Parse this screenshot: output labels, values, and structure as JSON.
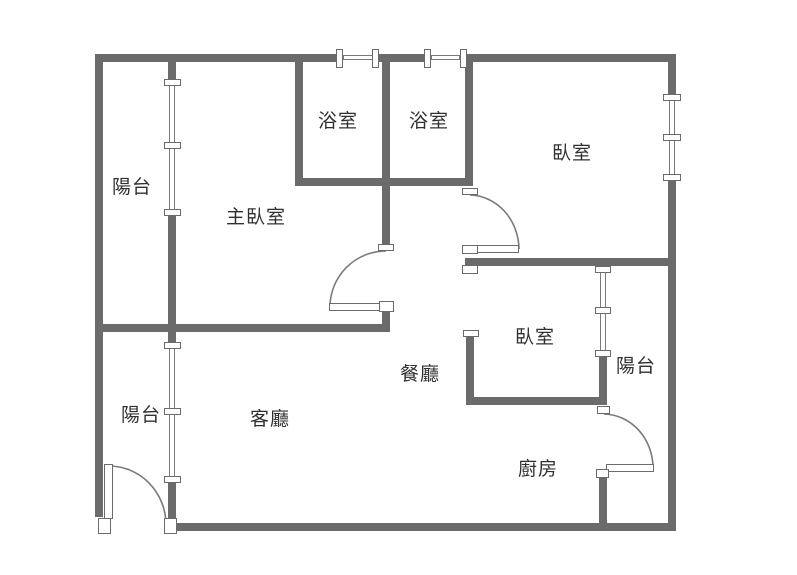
{
  "plan_title": "2房2衛浴 floor plan",
  "rooms": {
    "balcony_top": "陽台",
    "master_bedroom": "主臥室",
    "bathroom_left": "浴室",
    "bathroom_right": "浴室",
    "bedroom_top_right": "臥室",
    "dining_room": "餐廳",
    "bedroom_middle": "臥室",
    "balcony_right": "陽台",
    "living_room": "客廳",
    "balcony_bottom": "陽台",
    "kitchen": "廚房"
  },
  "colors": {
    "wall": "#6b6b6b",
    "line": "#7a7a7a",
    "label": "#303030",
    "bg": "#ffffff"
  }
}
